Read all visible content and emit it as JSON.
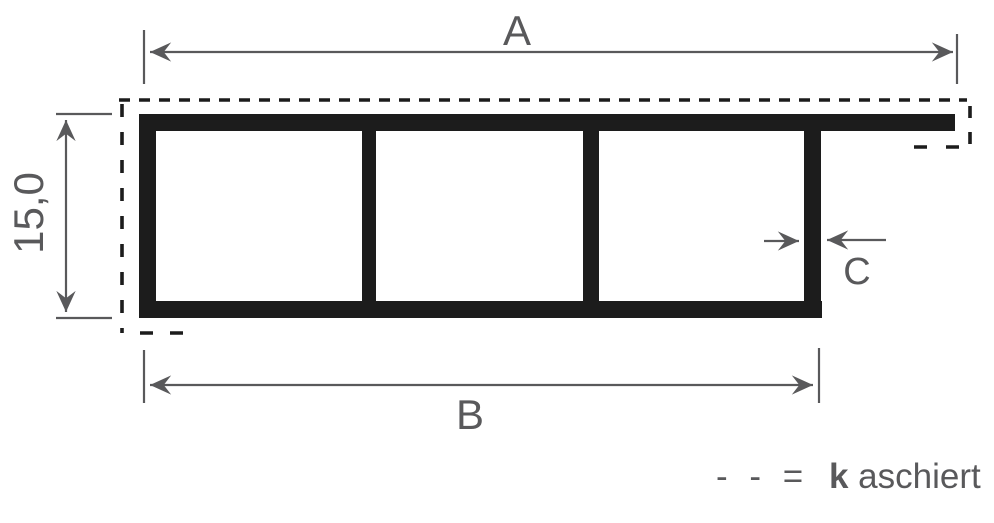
{
  "colors": {
    "profile": "#1c1c1c",
    "dimension": "#59595b",
    "background": "#ffffff"
  },
  "dimensions": {
    "total_width_label": "A",
    "body_width_label": "B",
    "wall_thickness_label": "C",
    "height_label": "15,0"
  },
  "legend": {
    "dash_symbol": "- - =",
    "term_bold": "k",
    "term_rest": "aschiert"
  }
}
